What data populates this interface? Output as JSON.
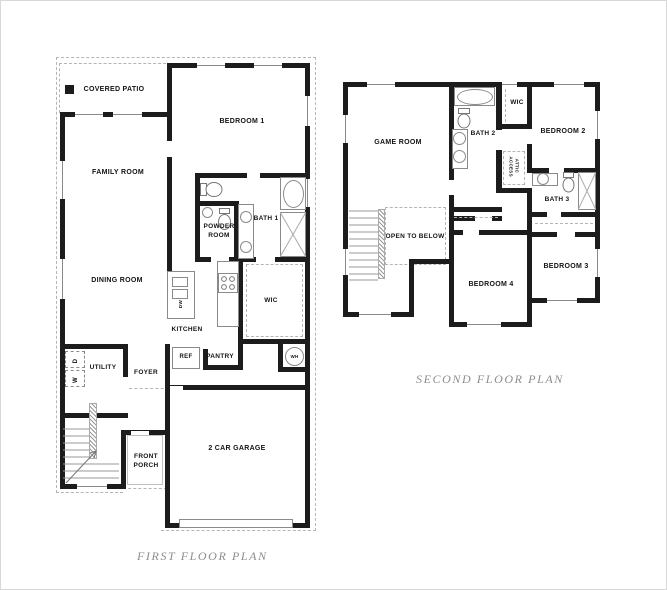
{
  "colors": {
    "wall": "#1c1c1c",
    "thin_line": "#8a8a8a",
    "dashed_line": "#b5b5b5",
    "label": "#141414",
    "caption": "#8d8d8d",
    "background": "#ffffff"
  },
  "first_floor": {
    "caption": "FIRST FLOOR PLAN",
    "covered_patio": "COVERED PATIO",
    "bedroom1": "BEDROOM 1",
    "family_room": "FAMILY ROOM",
    "dining_room": "DINING ROOM",
    "powder_room": "POWDER ROOM",
    "bath1": "BATH 1",
    "wic": "WIC",
    "kitchen": "KITCHEN",
    "utility": "UTILITY",
    "foyer": "FOYER",
    "ref": "REF",
    "pantry": "PANTRY",
    "wh": "WH",
    "dw": "DW",
    "washer": "W",
    "dryer": "D",
    "front_porch": "FRONT PORCH",
    "garage": "2 CAR GARAGE"
  },
  "second_floor": {
    "caption": "SECOND FLOOR PLAN",
    "game_room": "GAME ROOM",
    "bath2": "BATH 2",
    "wic": "WIC",
    "bedroom2": "BEDROOM 2",
    "attic_access": "ATTIC ACCESS",
    "bath3": "BATH 3",
    "open_to_below": "OPEN TO BELOW",
    "bedroom4": "BEDROOM 4",
    "bedroom3": "BEDROOM 3"
  }
}
